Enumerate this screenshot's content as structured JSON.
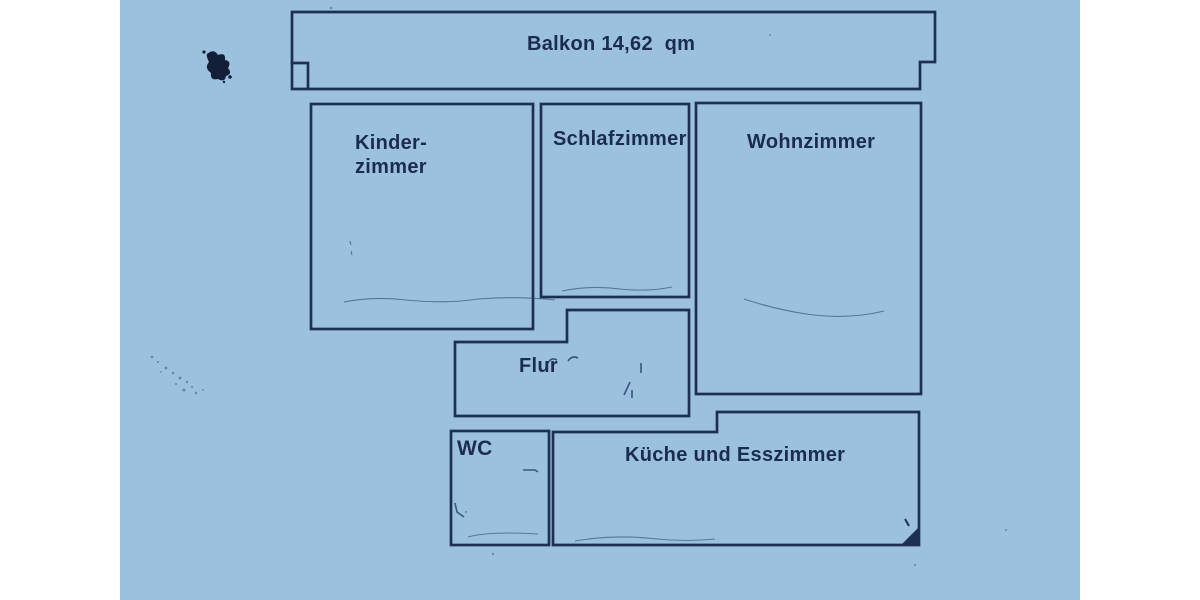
{
  "document": {
    "kind": "apartment floor plan scan",
    "paper_color": "#9cc1de",
    "wall_color": "#1d3053",
    "margin_color": "#fefefe"
  },
  "rooms": {
    "balkon": {
      "label": "Balkon 14,62  qm"
    },
    "kinderzimmer": {
      "label": "Kinder-\nzimmer"
    },
    "schlafzimmer": {
      "label": "Schlafzimmer"
    },
    "wohnzimmer": {
      "label": "Wohnzimmer"
    },
    "flur": {
      "label": "Flur"
    },
    "wc": {
      "label": "WC"
    },
    "kueche": {
      "label": "Küche und Esszimmer"
    }
  }
}
